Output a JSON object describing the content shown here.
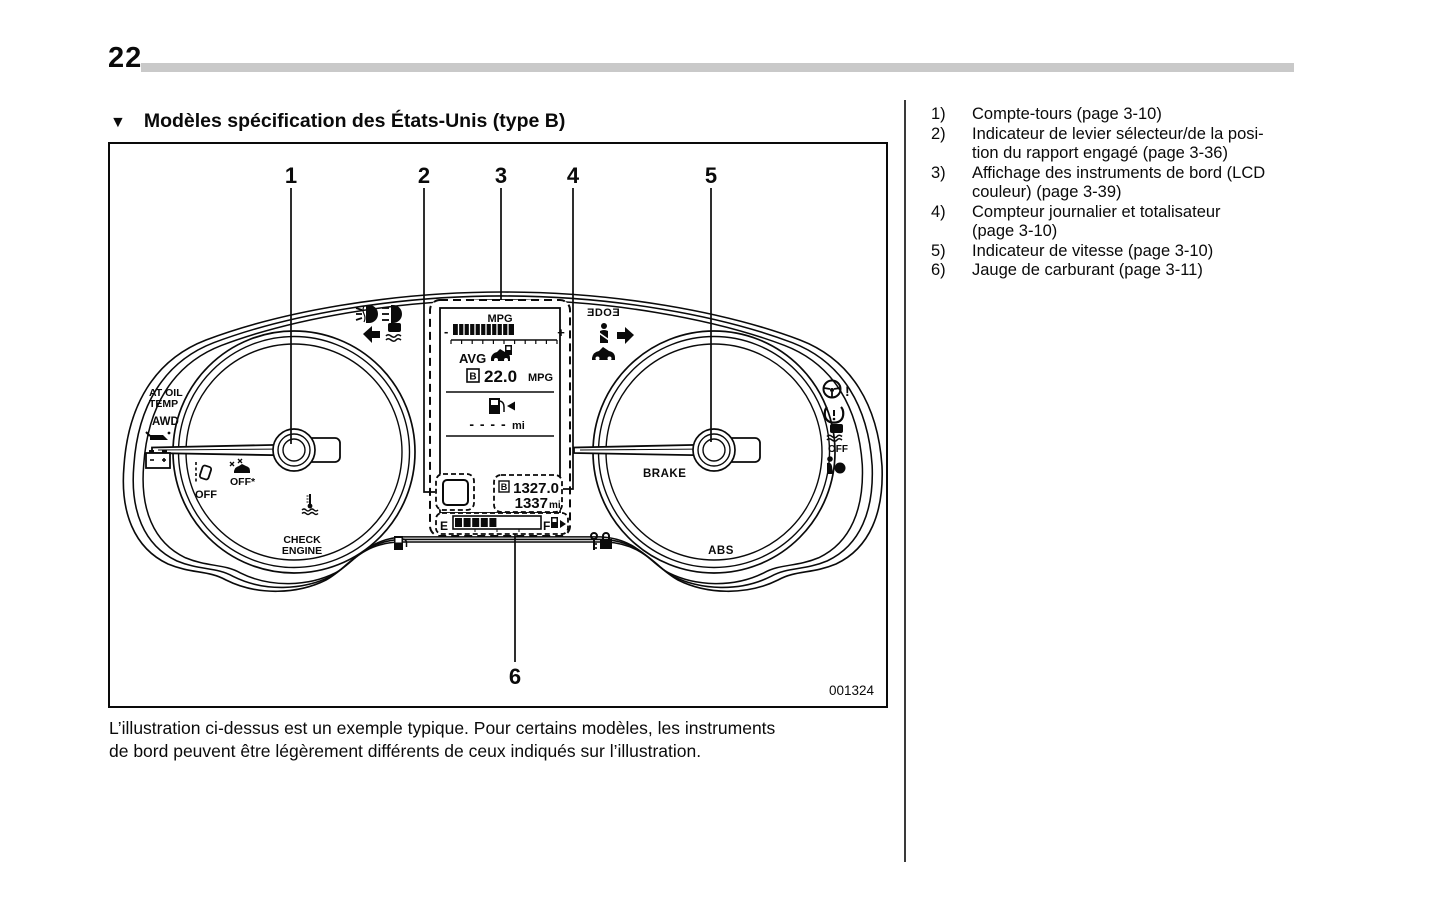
{
  "page": {
    "number": "22"
  },
  "heading": {
    "marker": "▼",
    "title": "Modèles spécification des États-Unis (type B)"
  },
  "figure": {
    "id_code": "001324",
    "callouts": [
      "1",
      "2",
      "3",
      "4",
      "5",
      "6"
    ],
    "lcd": {
      "mpg_title": "MPG",
      "bar_minus": "-",
      "bar_plus": "+",
      "avg_label": "AVG",
      "trip_selector": "B",
      "avg_value": "22.0",
      "avg_unit": "MPG",
      "range_value": "- - - -",
      "range_unit": "mi",
      "trip_value": "1327.0",
      "odo_value": "1337",
      "odo_unit": "mi",
      "fuel_empty": "E",
      "fuel_full": "F"
    },
    "labels": {
      "at_oil_1": "AT OIL",
      "at_oil_2": "TEMP",
      "awd": "AWD",
      "lane_off": "OFF",
      "sway_off": "OFF*",
      "check_1": "CHECK",
      "check_2": "ENGINE",
      "cruise": "ƎDOƎ",
      "vdc_off": "OFF",
      "brake": "BRAKE",
      "abs": "ABS",
      "steering_bang": "!"
    },
    "icons": {
      "turn_left_arrow": "◀",
      "turn_right_arrow": "▶",
      "fuel_bar_arrow": "▶"
    }
  },
  "caption": {
    "line1": "L’illustration ci-dessus est un exemple typique. Pour certains modèles, les instruments",
    "line2": "de bord peuvent être légèrement différents de ceux indiqués sur l’illustration."
  },
  "legend": {
    "items": [
      {
        "num": "1)",
        "lines": [
          "Compte-tours (page 3-10)"
        ]
      },
      {
        "num": "2)",
        "lines": [
          "Indicateur de levier sélecteur/de la posi-",
          "tion du rapport engagé (page 3-36)"
        ]
      },
      {
        "num": "3)",
        "lines": [
          "Affichage des instruments de bord (LCD",
          "couleur) (page 3-39)"
        ]
      },
      {
        "num": "4)",
        "lines": [
          "Compteur journalier et totalisateur",
          "(page 3-10)"
        ]
      },
      {
        "num": "5)",
        "lines": [
          "Indicateur de vitesse (page 3-10)"
        ]
      },
      {
        "num": "6)",
        "lines": [
          "Jauge de carburant (page 3-11)"
        ]
      }
    ]
  }
}
